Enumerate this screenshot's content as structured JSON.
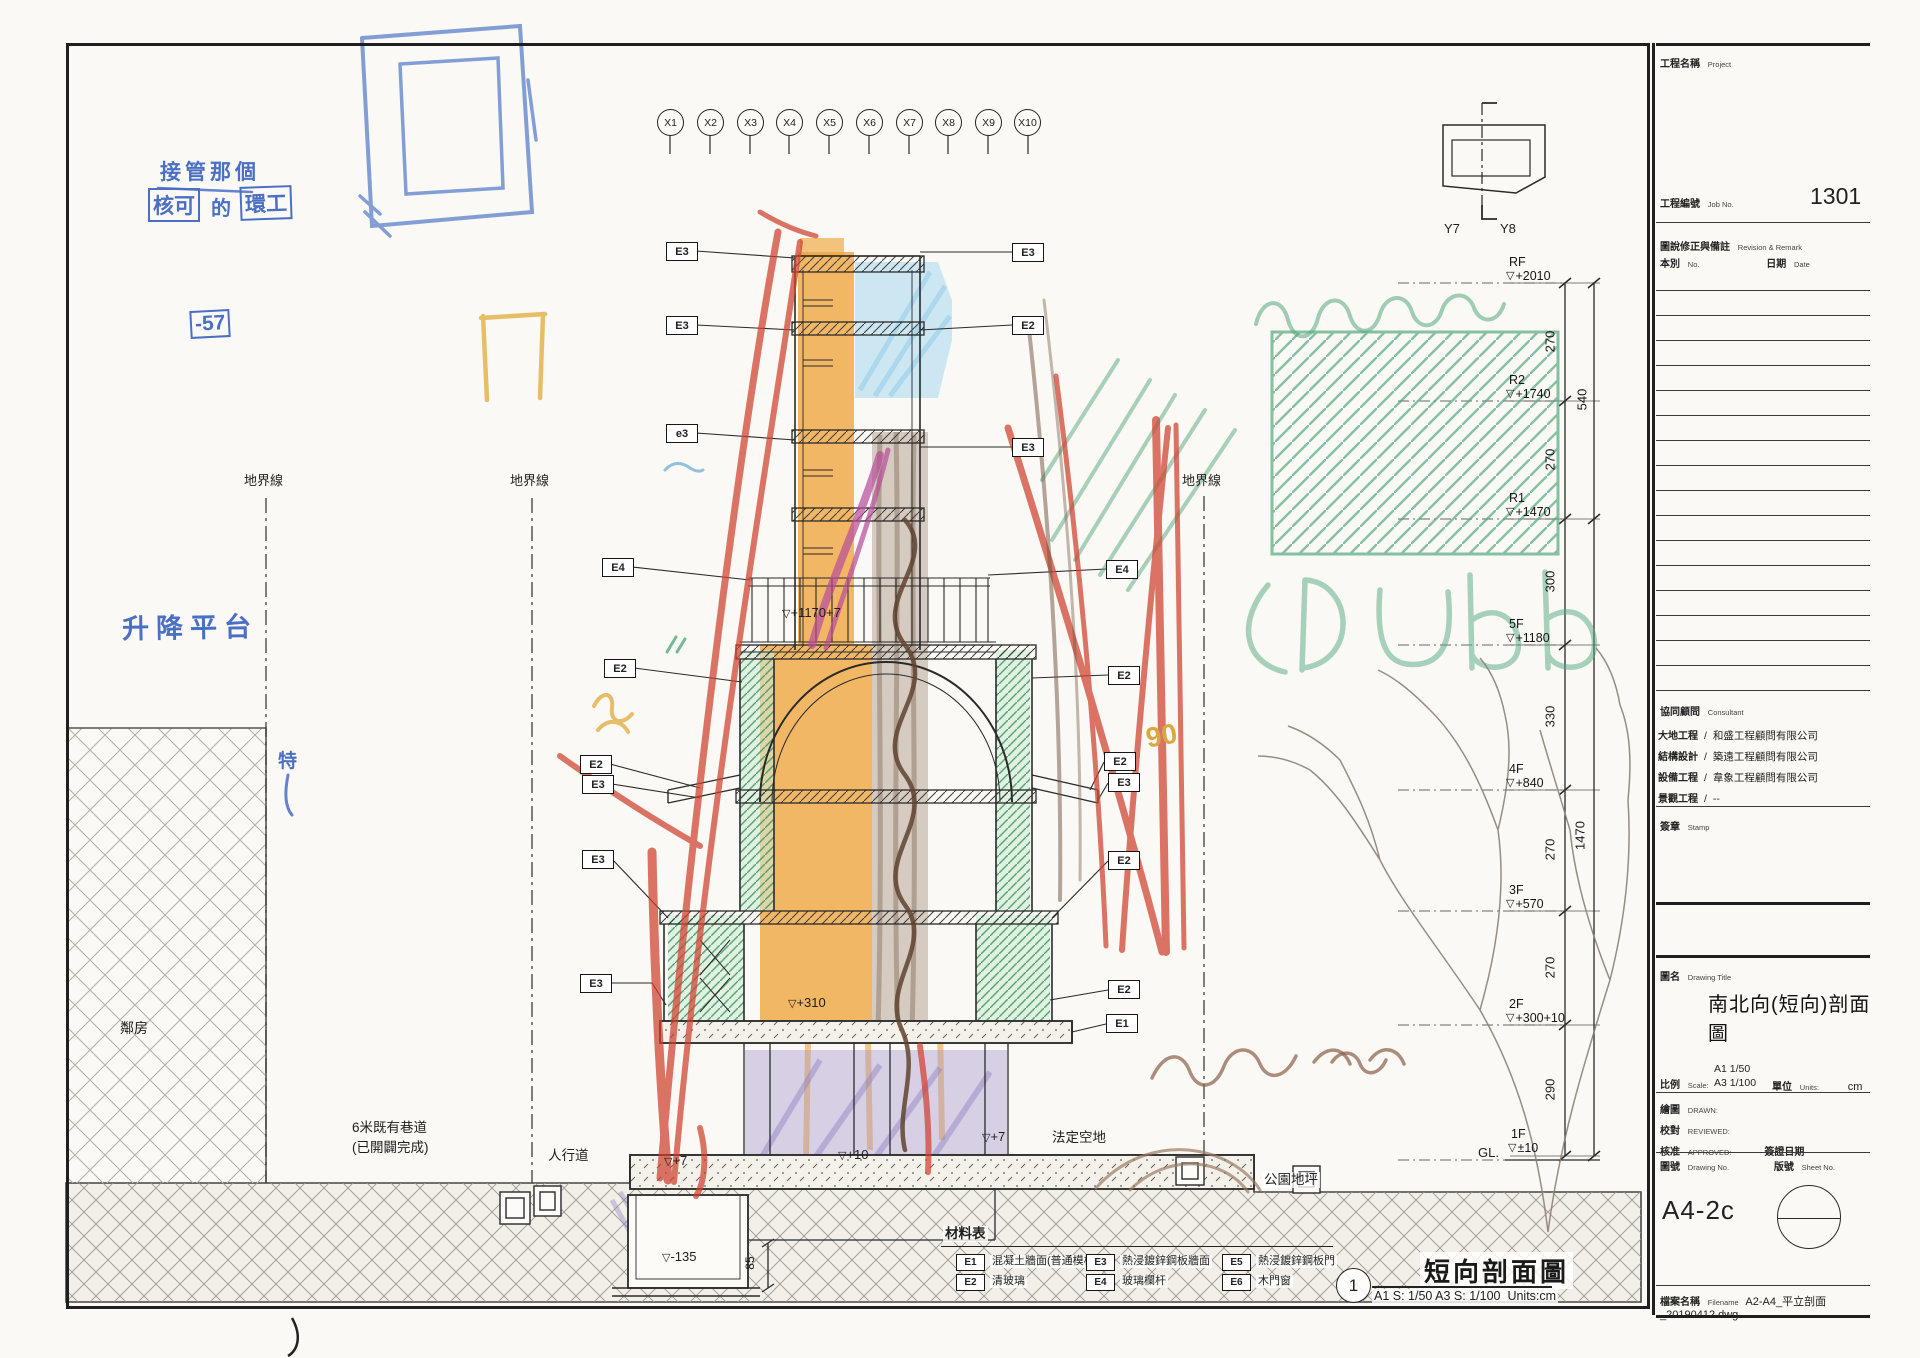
{
  "grid": {
    "x": [
      "X1",
      "X2",
      "X3",
      "X4",
      "X5",
      "X6",
      "X7",
      "X8",
      "X9",
      "X10"
    ],
    "y7": "Y7",
    "y8": "Y8"
  },
  "symbols": {
    "level_triangle": "▽"
  },
  "handwriting": {
    "line1": "接管那個",
    "box_a": "核可",
    "mid": "的",
    "box_b": "環工",
    "neg57": "-57",
    "platform": "升降平台",
    "char_te": "特",
    "num90": "90"
  },
  "site": {
    "boundary": "地界線",
    "neighbor": "鄰房",
    "road_1": "6米既有巷道",
    "road_2": "(已開闢完成)",
    "sidewalk": "人行道",
    "setback": "法定空地",
    "park": "公園地坪"
  },
  "levels": [
    {
      "floor": "RF",
      "value": "+2010"
    },
    {
      "floor": "R2",
      "value": "+1740"
    },
    {
      "floor": "R1",
      "value": "+1470"
    },
    {
      "floor": "5F",
      "value": "+1180"
    },
    {
      "floor": "4F",
      "value": "+840"
    },
    {
      "floor": "3F",
      "value": "+570"
    },
    {
      "floor": "2F",
      "value": "+300+10"
    },
    {
      "floor": "1F",
      "value": "±10"
    }
  ],
  "gl": "GL.",
  "dims": {
    "segments": [
      "270",
      "270",
      "300",
      "330",
      "270",
      "270",
      "290"
    ],
    "total_upper": "540",
    "total_lower": "1470",
    "pit": "85"
  },
  "section_marks": {
    "terrace": "+1170+7",
    "slab2f": "+310",
    "left_walk": "+7",
    "entry": "+10",
    "right_walk": "+7",
    "pit_depth": "-135"
  },
  "callouts_left": [
    {
      "code": "E3"
    },
    {
      "code": "E3"
    },
    {
      "code": "e3"
    },
    {
      "code": "E4"
    },
    {
      "code": "E2"
    },
    {
      "code": "E2"
    },
    {
      "code": "E3"
    },
    {
      "code": "E3"
    },
    {
      "code": "E3"
    }
  ],
  "callouts_right": [
    {
      "code": "E3"
    },
    {
      "code": "E2"
    },
    {
      "code": "E3"
    },
    {
      "code": "E4"
    },
    {
      "code": "E2"
    },
    {
      "code": "E2"
    },
    {
      "code": "E3"
    },
    {
      "code": "E2"
    },
    {
      "code": "E2"
    },
    {
      "code": "E1"
    }
  ],
  "legend": {
    "title": "材料表",
    "items": [
      {
        "code": "E1",
        "label": "混凝土牆面(普通模板)"
      },
      {
        "code": "E2",
        "label": "清玻璃"
      },
      {
        "code": "E3",
        "label": "熱浸鍍鋅鋼板牆面"
      },
      {
        "code": "E4",
        "label": "玻璃欄杆"
      },
      {
        "code": "E5",
        "label": "熱浸鍍鋅鋼板門"
      },
      {
        "code": "E6",
        "label": "木門窗"
      }
    ]
  },
  "view_title": {
    "number": "1",
    "title": "短向剖面圖",
    "scale": "A1 S: 1/50  A3 S: 1/100",
    "units": "Units:cm"
  },
  "titleblock": {
    "project_label": "工程名稱",
    "project_en": "Project",
    "job_label": "工程編號",
    "job_en": "Job No.",
    "job_no": "1301",
    "rev_label": "圖說修正與備註",
    "rev_en": "Revision & Remark",
    "no_label": "本別",
    "no_en": "No.",
    "date_label": "日期",
    "date_en": "Date",
    "consultant_label": "協同顧問",
    "consultant_en": "Consultant",
    "sep": "/",
    "consultants": [
      {
        "role": "大地工程",
        "name": "和盛工程顧問有限公司"
      },
      {
        "role": "結構設計",
        "name": "築遠工程顧問有限公司"
      },
      {
        "role": "設備工程",
        "name": "韋象工程顧問有限公司"
      },
      {
        "role": "景觀工程",
        "name": "--"
      }
    ],
    "stamp_label": "簽章",
    "stamp_en": "Stamp",
    "name_label": "圖名",
    "name_en": "Drawing Title",
    "drawing_title": "南北向(短向)剖面圖",
    "scale_label": "比例",
    "scale_en": "Scale:",
    "scale_a1": "A1 1/50",
    "scale_a3": "A3 1/100",
    "unit_label": "單位",
    "unit_en": "Units:",
    "unit_value": "cm",
    "drawn_label": "繪圖",
    "drawn_en": "DRAWN:",
    "reviewed_label": "校對",
    "reviewed_en": "REVIEWED:",
    "approved_label": "核准",
    "approved_en": "APPROVED:",
    "sign_date": "簽證日期",
    "dno_label": "圖號",
    "dno_en": "Drawing No.",
    "sno_label": "版號",
    "sno_en": "Sheet No.",
    "sheet_code": "A4-2c",
    "file_label": "檔案名稱",
    "file_en": "Filename",
    "filename": "A2-A4_平立剖面_20190412.dwg"
  }
}
